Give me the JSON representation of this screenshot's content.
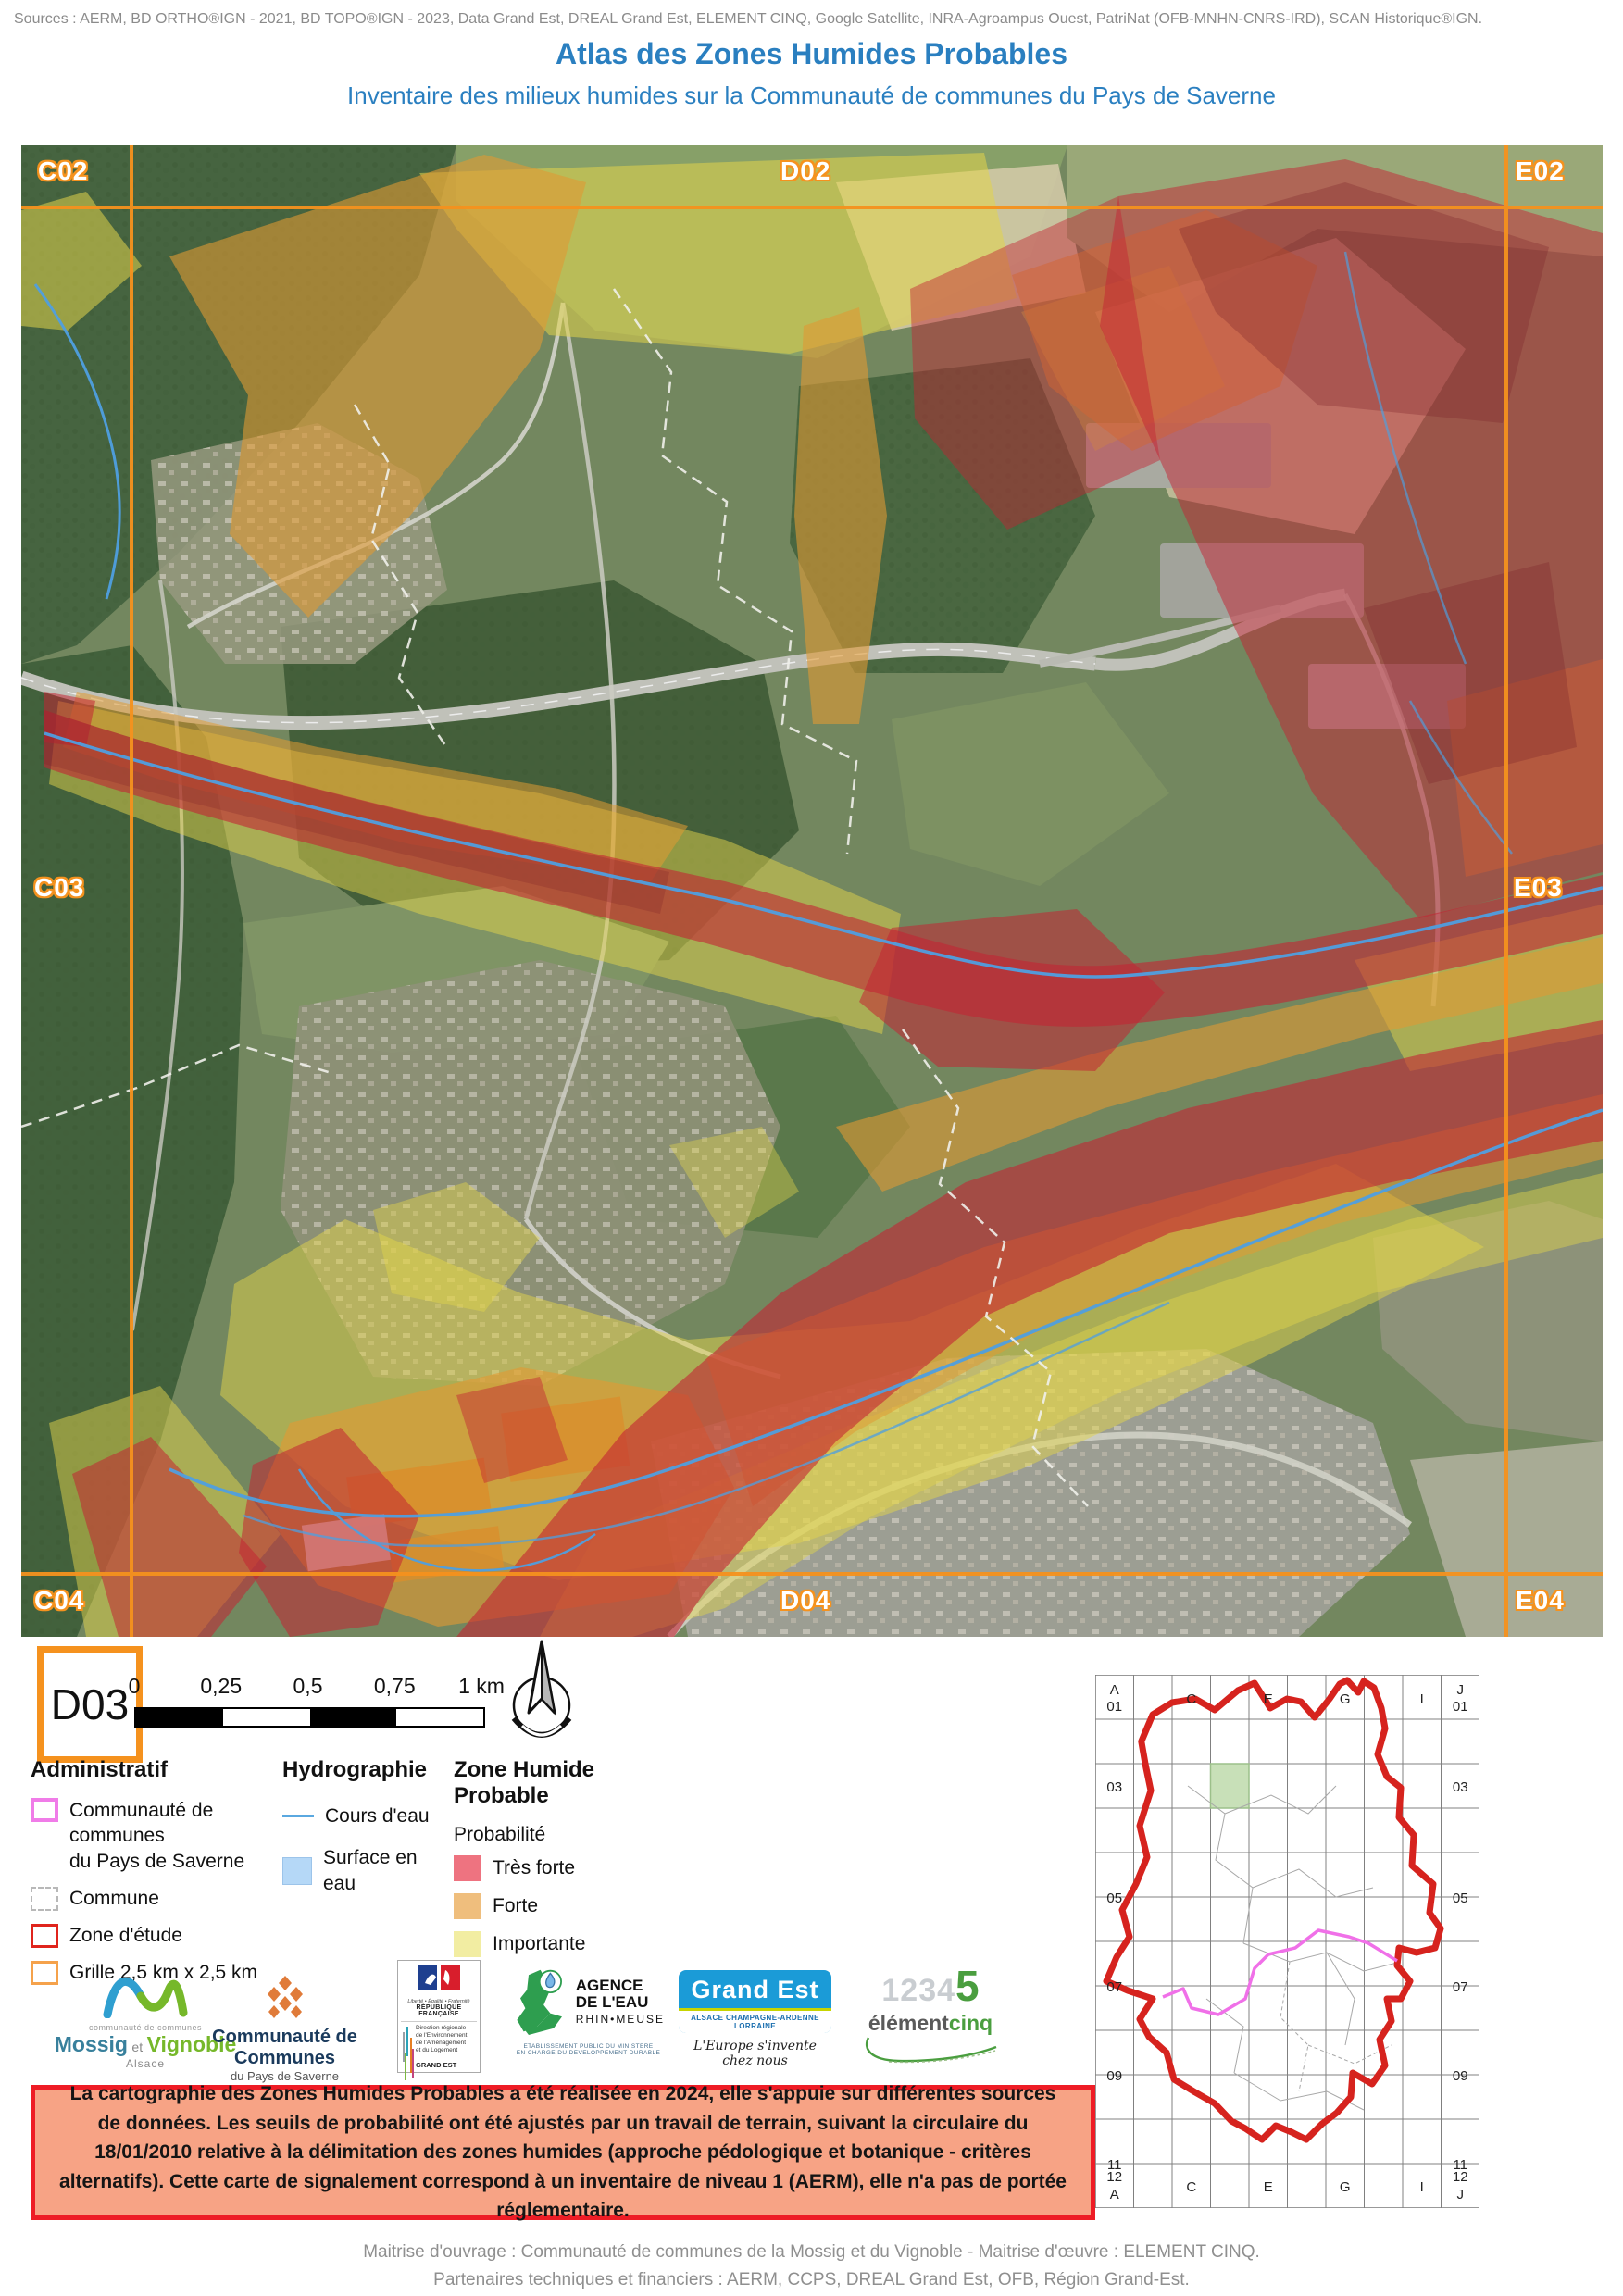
{
  "header": {
    "sources": "Sources : AERM, BD ORTHO®IGN - 2021, BD TOPO®IGN - 2023, Data Grand Est, DREAL Grand Est, ELEMENT CINQ, Google Satellite, INRA-Agroampus Ouest, PatriNat (OFB-MNHN-CNRS-IRD), SCAN Historique®IGN.",
    "title": "Atlas des Zones Humides Probables",
    "subtitle": "Inventaire des milieux humides sur la Communauté de communes du Pays de Saverne"
  },
  "map": {
    "grid_labels": [
      "C02",
      "D02",
      "E02",
      "C03",
      "E03",
      "C04",
      "D04",
      "E04"
    ],
    "current_cell": "D03"
  },
  "scalebar": {
    "ticks": [
      "0",
      "0,25",
      "0,5",
      "0,75",
      "1 km"
    ]
  },
  "legend": {
    "administratif": {
      "title": "Administratif",
      "items": [
        {
          "line1": "Communauté de communes",
          "line2": "du Pays de Saverne"
        },
        {
          "label": "Commune"
        },
        {
          "label": "Zone d'étude"
        },
        {
          "label": "Grille 2,5 km x 2,5 km"
        }
      ]
    },
    "hydrographie": {
      "title": "Hydrographie",
      "items": [
        {
          "label": "Cours d'eau"
        },
        {
          "label": "Surface en eau"
        }
      ]
    },
    "zone_humide": {
      "title": "Zone Humide Probable",
      "subtitle": "Probabilité",
      "items": [
        {
          "label": "Très forte",
          "color": "#ee7380"
        },
        {
          "label": "Forte",
          "color": "#efbe7d"
        },
        {
          "label": "Importante",
          "color": "#f2eda2"
        }
      ]
    }
  },
  "logos": {
    "mossig": {
      "small": "communauté de communes",
      "name1": "Mossig",
      "et": "et",
      "name2": "Vignoble",
      "region": "Alsace"
    },
    "saverne": {
      "line1": "Communauté de Communes",
      "line2": "du Pays de Saverne"
    },
    "dreal": {
      "motto": "Liberté • Égalité • Fraternité",
      "republic": "RÉPUBLIQUE FRANÇAISE",
      "dir1": "Direction régionale",
      "dir2": "de l'Environnement,",
      "dir3": "de l'Aménagement",
      "dir4": "et du Logement",
      "region": "GRAND EST"
    },
    "agence": {
      "name1": "AGENCE",
      "name2": "DE L'EAU",
      "name3": "RHIN•MEUSE",
      "sub1": "ETABLISSEMENT PUBLIC DU MINISTERE",
      "sub2": "EN CHARGE DU DEVELOPPEMENT DURABLE"
    },
    "grandest": {
      "name_a": "Grand",
      "name_b": "Est",
      "band": "ALSACE CHAMPAGNE-ARDENNE LORRAINE",
      "slogan": "L'Europe s'invente chez nous"
    },
    "element5": {
      "digits": "1234",
      "five": "5",
      "name1": "élément",
      "name2": "cinq"
    }
  },
  "notice": {
    "text": "La cartographie des Zones Humides Probables a été réalisée en 2024, elle s'appuie sur différentes sources de données. Les seuils de probabilité ont été ajustés par un travail de terrain, suivant la circulaire du 18/01/2010 relative à la délimitation des zones humides (approche pédologique et botanique - critères alternatifs). Cette carte de signalement correspond à un inventaire de niveau 1 (AERM), elle n'a pas de portée réglementaire."
  },
  "overview": {
    "a": "A",
    "a01": "01",
    "c": "C",
    "e": "E",
    "g": "G",
    "i": "I",
    "j": "J",
    "j01": "01",
    "r03": "03",
    "r05": "05",
    "r07": "07",
    "r09": "09",
    "r11": "11",
    "b12": "12",
    "bA": "A",
    "bJ": "J"
  },
  "footer": {
    "line1": "Maitrise d'ouvrage : Communauté de communes de la Mossig et du Vignoble - Maitrise d'œuvre : ELEMENT CINQ.",
    "line2": "Partenaires techniques et financiers : AERM, CCPS, DREAL Grand Est, OFB, Région Grand-Est."
  },
  "colors": {
    "title_blue": "#2a7fc0",
    "grid_orange": "#f5921e",
    "tres_forte": "#ee7380",
    "forte": "#efbe7d",
    "importante": "#f2eda2",
    "cours_eau": "#5aa8e0",
    "surface_eau": "#b5d8f7",
    "cc_pays_saverne": "#f07ce8",
    "zone_etude": "#e0241c",
    "notice_bg": "#f7a385",
    "notice_border": "#ee1c25",
    "overview_boundary_red": "#d6231e",
    "overview_cc_magenta": "#f070e8",
    "overview_cell_green": "#c8e0b8"
  }
}
